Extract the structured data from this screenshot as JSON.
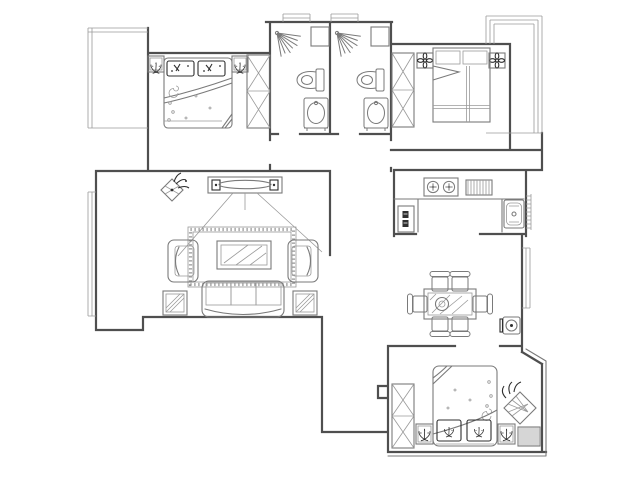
{
  "meta": {
    "type": "apartment-floor-plan",
    "width": 640,
    "height": 485
  },
  "colors": {
    "background": "#ffffff",
    "wall": "#4f4f4f",
    "furniture": "#7a7a7a",
    "detail": "#9a9a9a",
    "dark": "#2f2f2f"
  },
  "rooms": {
    "master_bedroom": {
      "icons": [
        "double-bed",
        "pillow",
        "pillow",
        "nightstand-plant",
        "nightstand-plant",
        "wardrobe",
        "bay-window"
      ]
    },
    "bathroom_1": {
      "icons": [
        "shower-spray",
        "toilet",
        "washbasin",
        "duct",
        "window"
      ]
    },
    "bathroom_2": {
      "icons": [
        "shower-spray",
        "toilet",
        "washbasin",
        "duct",
        "window"
      ]
    },
    "bedroom_2": {
      "icons": [
        "bed",
        "nightstand-flower",
        "nightstand-flower",
        "wardrobe",
        "balcony"
      ]
    },
    "kitchen": {
      "icons": [
        "counter",
        "gas-stove-burner",
        "gas-stove-burner",
        "vent-hatch",
        "sink",
        "refrigerator"
      ]
    },
    "living_room": {
      "icons": [
        "tv-unit",
        "speaker",
        "speaker",
        "rug",
        "coffee-table",
        "sofa",
        "armchair",
        "armchair",
        "side-table",
        "side-table",
        "plant",
        "bay-window"
      ]
    },
    "dining_area": {
      "icons": [
        "dining-table",
        "plate",
        "chair",
        "chair",
        "chair",
        "chair",
        "chair",
        "chair",
        "water-heater",
        "window"
      ]
    },
    "bedroom_3": {
      "icons": [
        "bed",
        "pillow",
        "pillow",
        "nightstand-plant",
        "nightstand-plant",
        "wardrobe",
        "plant",
        "hatched-window"
      ]
    }
  }
}
